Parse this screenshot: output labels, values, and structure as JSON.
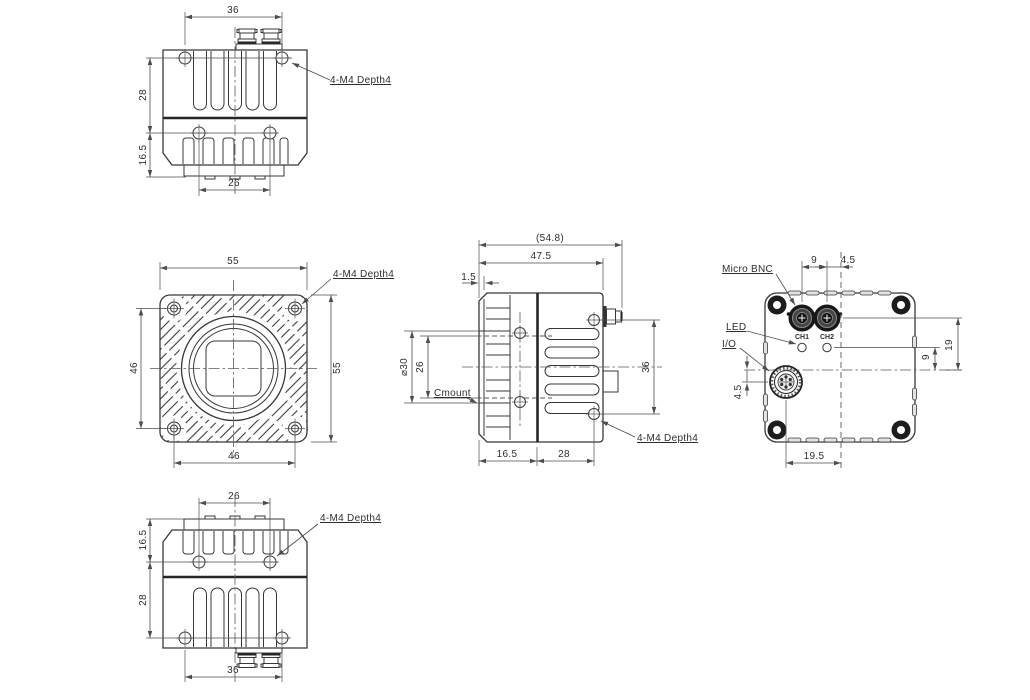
{
  "views": {
    "top": {
      "dim_connector_width": "36",
      "dim_rear_height": "28",
      "dim_front_height": "16.5",
      "dim_front_hole_spacing": "26",
      "thread_label": "4-M4 Depth4"
    },
    "front": {
      "dim_width": "55",
      "dim_height": "55",
      "dim_hole_spacing_v": "46",
      "dim_hole_spacing_h": "46",
      "thread_label": "4-M4 Depth4"
    },
    "side": {
      "dim_overall_depth": "(54.8)",
      "dim_body_depth": "47.5",
      "dim_flange": "1.5",
      "dim_mount_diameter": "⌀30",
      "dim_mount_opening": "26",
      "dim_hole_spacing": "36",
      "dim_front_depth": "16.5",
      "dim_rear_depth": "28",
      "mount_label": "Cmount",
      "thread_label": "4-M4 Depth4"
    },
    "back": {
      "dim_bnc_spacing": "9",
      "dim_bnc_offset": "4.5",
      "dim_bnc_height": "19",
      "dim_led_height": "9",
      "dim_io_offset_v": "4.5",
      "dim_io_offset_h": "19.5",
      "label_micro_bnc": "Micro BNC",
      "label_led": "LED",
      "label_io": "I/O",
      "label_ch1": "CH1",
      "label_ch2": "CH2"
    },
    "bottom": {
      "dim_front_hole_spacing": "26",
      "dim_front_height": "16.5",
      "dim_rear_height": "28",
      "dim_connector_width": "36",
      "thread_label": "4-M4 Depth4"
    }
  },
  "colors": {
    "line": "#383838",
    "dim": "#4d4d4d",
    "dark_fill": "#1d1d1d",
    "background": "#ffffff"
  }
}
